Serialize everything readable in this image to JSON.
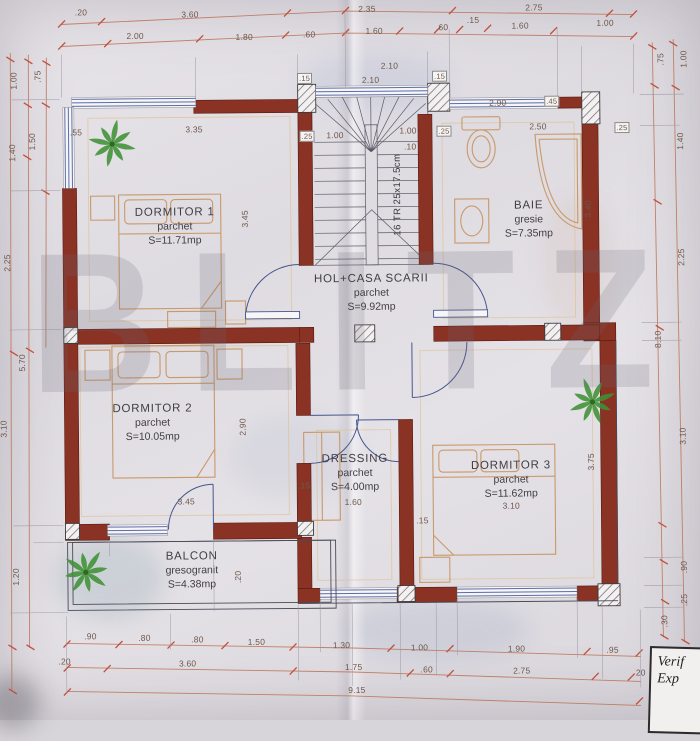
{
  "watermark": {
    "text": "BLITZ"
  },
  "stair": {
    "label": "16 TR 25x17.5cm"
  },
  "title_block": {
    "line1": "Verif",
    "line2": "Exp"
  },
  "rooms": {
    "dormitor1": {
      "name": "DORMITOR 1",
      "finish": "parchet",
      "area": "S=11.71mp"
    },
    "baie": {
      "name": "BAIE",
      "finish": "gresie",
      "area": "S=7.35mp"
    },
    "hol": {
      "name": "HOL+CASA SCARII",
      "finish": "parchet",
      "area": "S=9.92mp"
    },
    "dormitor2": {
      "name": "DORMITOR 2",
      "finish": "parchet",
      "area": "S=10.05mp"
    },
    "dressing": {
      "name": "DRESSING",
      "finish": "parchet",
      "area": "S=4.00mp"
    },
    "dormitor3": {
      "name": "DORMITOR 3",
      "finish": "parchet",
      "area": "S=11.62mp"
    },
    "balcon": {
      "name": "BALCON",
      "finish": "gresogranit",
      "area": "S=4.38mp"
    }
  },
  "colors": {
    "wall": "#8a3325",
    "window_blue": "#5d6da6",
    "door_blue": "#46568e",
    "furniture": "#c9996a",
    "dim_line": "#bd7055",
    "tick": "#c0503c",
    "plant": "#3f9135"
  },
  "dim_labels": [
    {
      "t": ".20",
      "x": 84,
      "y": 10
    },
    {
      "t": "3.60",
      "x": 193,
      "y": 13
    },
    {
      "t": "2.35",
      "x": 370,
      "y": 9
    },
    {
      "t": "2.75",
      "x": 537,
      "y": 9
    },
    {
      "t": "2.00",
      "x": 138,
      "y": 34
    },
    {
      "t": "1.80",
      "x": 247,
      "y": 36
    },
    {
      "t": ".60",
      "x": 312,
      "y": 34
    },
    {
      "t": "1.60",
      "x": 377,
      "y": 31
    },
    {
      "t": ".60",
      "x": 445,
      "y": 28
    },
    {
      "t": ".15",
      "x": 476,
      "y": 21
    },
    {
      "t": "1.60",
      "x": 523,
      "y": 27
    },
    {
      "t": "1.00",
      "x": 608,
      "y": 25
    },
    {
      "t": "1.00",
      "x": 16,
      "y": 78,
      "r": -90
    },
    {
      "t": ".75",
      "x": 40,
      "y": 74,
      "r": -90
    },
    {
      "t": "1.40",
      "x": 14,
      "y": 150,
      "r": -90
    },
    {
      "t": "1.50",
      "x": 34,
      "y": 139,
      "r": -90
    },
    {
      "t": "2.25",
      "x": 8,
      "y": 260,
      "r": -90
    },
    {
      "t": "5.70",
      "x": 22,
      "y": 360,
      "r": -90
    },
    {
      "t": "3.10",
      "x": 3,
      "y": 426,
      "r": -90
    },
    {
      "t": "1.20",
      "x": 14,
      "y": 574,
      "r": -90
    },
    {
      "t": ".75",
      "x": 663,
      "y": 62,
      "r": -90
    },
    {
      "t": "1.00",
      "x": 686,
      "y": 62,
      "r": -90
    },
    {
      "t": "1.40",
      "x": 682,
      "y": 144,
      "r": -90
    },
    {
      "t": "2.25",
      "x": 682,
      "y": 260,
      "r": -90
    },
    {
      "t": "8.10",
      "x": 658,
      "y": 342,
      "r": -90
    },
    {
      "t": "3.10",
      "x": 682,
      "y": 439,
      "r": -90
    },
    {
      "t": ".90",
      "x": 682,
      "y": 570,
      "r": -90
    },
    {
      "t": ".25",
      "x": 682,
      "y": 603,
      "r": -90
    },
    {
      "t": ".30",
      "x": 662,
      "y": 624,
      "r": -90
    },
    {
      "t": ".90",
      "x": 88,
      "y": 634
    },
    {
      "t": ".80",
      "x": 142,
      "y": 636
    },
    {
      "t": ".80",
      "x": 195,
      "y": 638
    },
    {
      "t": "1.50",
      "x": 254,
      "y": 641
    },
    {
      "t": "1.30",
      "x": 339,
      "y": 645
    },
    {
      "t": "1.00",
      "x": 417,
      "y": 648
    },
    {
      "t": "1.90",
      "x": 514,
      "y": 650
    },
    {
      "t": ".95",
      "x": 610,
      "y": 652
    },
    {
      "t": ".20",
      "x": 62,
      "y": 659
    },
    {
      "t": "3.60",
      "x": 185,
      "y": 662
    },
    {
      "t": "1.75",
      "x": 351,
      "y": 667
    },
    {
      "t": ".60",
      "x": 424,
      "y": 670
    },
    {
      "t": "2.75",
      "x": 519,
      "y": 672
    },
    {
      "t": "20",
      "x": 638,
      "y": 675
    },
    {
      "t": "9.15",
      "x": 354,
      "y": 690
    },
    {
      "t": "3.35",
      "x": 196,
      "y": 128
    },
    {
      "t": ".55",
      "x": 78,
      "y": 130
    },
    {
      "t": "2.10",
      "x": 392,
      "y": 66
    },
    {
      "t": "2.10",
      "x": 373,
      "y": 80
    },
    {
      "t": ".15",
      "x": 307,
      "y": 78,
      "b": 1
    },
    {
      "t": ".15",
      "x": 442,
      "y": 77,
      "b": 1
    },
    {
      "t": ".25",
      "x": 309,
      "y": 136,
      "b": 1
    },
    {
      "t": "1.00",
      "x": 337,
      "y": 135
    },
    {
      "t": "1.00",
      "x": 410,
      "y": 131
    },
    {
      "t": ".25",
      "x": 446,
      "y": 132,
      "b": 1
    },
    {
      "t": ".10",
      "x": 412,
      "y": 147
    },
    {
      "t": "2.90",
      "x": 500,
      "y": 104
    },
    {
      "t": "2.50",
      "x": 540,
      "y": 128
    },
    {
      "t": ".45",
      "x": 554,
      "y": 103,
      "b": 1
    },
    {
      "t": ".25",
      "x": 624,
      "y": 130,
      "b": 1
    },
    {
      "t": "3.45",
      "x": 246,
      "y": 218,
      "r": -90
    },
    {
      "t": "3.40",
      "x": 589,
      "y": 211,
      "r": -90
    },
    {
      "t": "2.90",
      "x": 242,
      "y": 426,
      "r": -90
    },
    {
      "t": "3.45",
      "x": 185,
      "y": 500
    },
    {
      "t": ".15",
      "x": 303,
      "y": 485
    },
    {
      "t": "1.60",
      "x": 352,
      "y": 502
    },
    {
      "t": "3.10",
      "x": 510,
      "y": 507
    },
    {
      "t": ".15",
      "x": 421,
      "y": 521
    },
    {
      "t": "3.75",
      "x": 590,
      "y": 464,
      "r": -90
    },
    {
      "t": ".20",
      "x": 236,
      "y": 576,
      "r": -90
    }
  ]
}
